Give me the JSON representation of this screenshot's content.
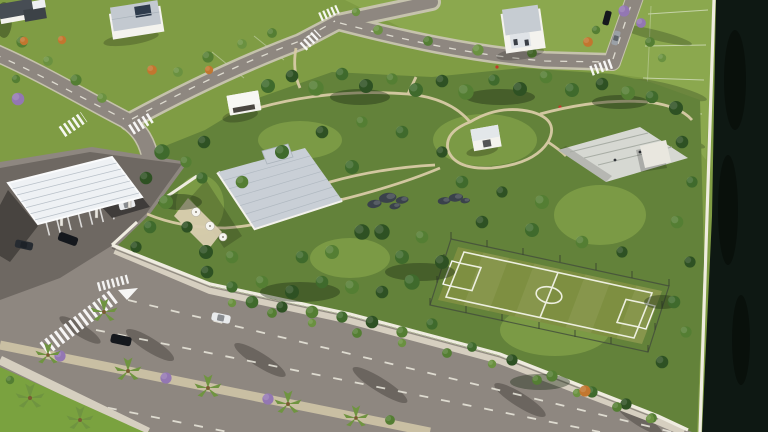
{
  "meta": {
    "type": "aerial-3d-architectural-render",
    "description": "Bird's-eye 3D rendering of a gated residential community: a central wooded park with a white flat-roof clubhouse, garden pavilion, restroom cube, rock gardens, a concrete skate park and a fenced soccer field, all enclosed by a white perimeter wall; an entrance gatehouse with a large white canopy and parking at the left; a wide avenue with a palm-planted median along the bottom; a street grid with zebra crosswalks, houses and vacant green lots at the top; and a dark canal running along the right edge.",
    "lighting": "late-afternoon sun from the upper right casting shadows toward the lower left"
  },
  "colors": {
    "lawn_base": "#7f9c44",
    "lawn_bright": "#8ba84e",
    "lawn_bl": "#7aa23f",
    "park_base": "#63823a",
    "clearing": "#7b9a45",
    "tree_dark": "#2e5123",
    "tree_mid": "#3f6a2c",
    "tree_light": "#547e33",
    "tree_pale": "#6a9140",
    "palm": "#6f9440",
    "jacaranda": "#9377b3",
    "orange_tree": "#c2762f",
    "road": "#8e8780",
    "road_casing": "#cdc7b8",
    "plaza": "#6e6862",
    "sidewalk": "#d6cfc0",
    "wall": "#efece0",
    "median": "#c9bfa3",
    "marking": "#eceadf",
    "path": "#d8cba6",
    "water": "#0e1813",
    "roof": "#c9cfd6",
    "white_wall": "#f4f3ee",
    "concrete": "#d6d8d2",
    "field": "#7e8f41",
    "field_line": "#edefdf",
    "fence": "#44503c",
    "rock": "#3a424b",
    "terrace": "#d9cdb0",
    "car_dark": "#15181d",
    "car_white": "#e9ebed"
  },
  "scene": {
    "areas": [
      "residential lots with white houses (top-left)",
      "street grid with dashed lane lines and zebra crosswalks (top)",
      "vacant green lots with white boundary lines (top-right)",
      "dark canal behind a white edge wall (right edge)",
      "dense wooded community park (center)",
      "entrance gatehouse with white canopy, guard booth and striped parking (left)",
      "white clubhouse with terrace and umbrellas (center-left)",
      "garden pavilion and restroom cube (park interior)",
      "concrete skate park (center-right)",
      "fenced soccer field with white markings and goals (right-center)",
      "white perimeter wall around the park",
      "wide avenue with palm and jacaranda planted median (bottom)",
      "lawn corner with palms (bottom-left)"
    ],
    "counts": {
      "houses": 3,
      "park_structures": 5,
      "cars": 7,
      "palm_trees": 8,
      "zebra_crosswalks": 7,
      "soccer_fields": 1,
      "road_arrows": 1
    }
  }
}
